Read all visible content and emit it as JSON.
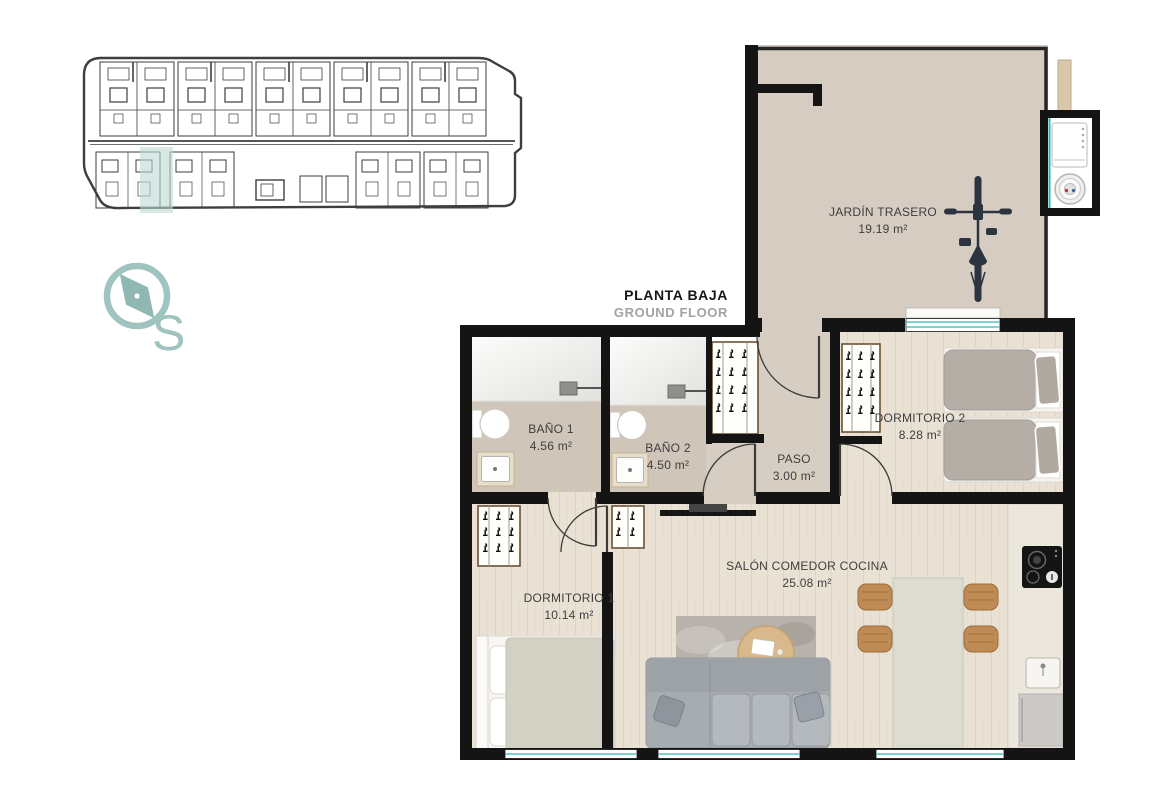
{
  "header": {
    "title": "PLANTA BAJA",
    "subtitle": "GROUND FLOOR"
  },
  "compass": {
    "letter": "S"
  },
  "rooms": {
    "jardin": {
      "name": "JARDÍN TRASERO",
      "area": "19.19 m²"
    },
    "bano1": {
      "name": "BAÑO 1",
      "area": "4.56 m²"
    },
    "bano2": {
      "name": "BAÑO 2",
      "area": "4.50 m²"
    },
    "paso": {
      "name": "PASO",
      "area": "3.00 m²"
    },
    "dorm2": {
      "name": "DORMITORIO 2",
      "area": "8.28 m²"
    },
    "dorm1": {
      "name": "DORMITORIO 1",
      "area": "10.14 m²"
    },
    "salon": {
      "name": "SALÓN COMEDOR COCINA",
      "area": "25.08 m²"
    }
  },
  "colors": {
    "accent_teal": "#35b8b4",
    "compass_teal": "#9fc3be",
    "wall": "#141414",
    "wood_floor": "#e9e2d4",
    "bath_floor": "#cfc5b9",
    "hall_floor": "#d7cec3",
    "garden_floor": "#d6ccc1",
    "site_highlight": "#bcd8d4"
  }
}
